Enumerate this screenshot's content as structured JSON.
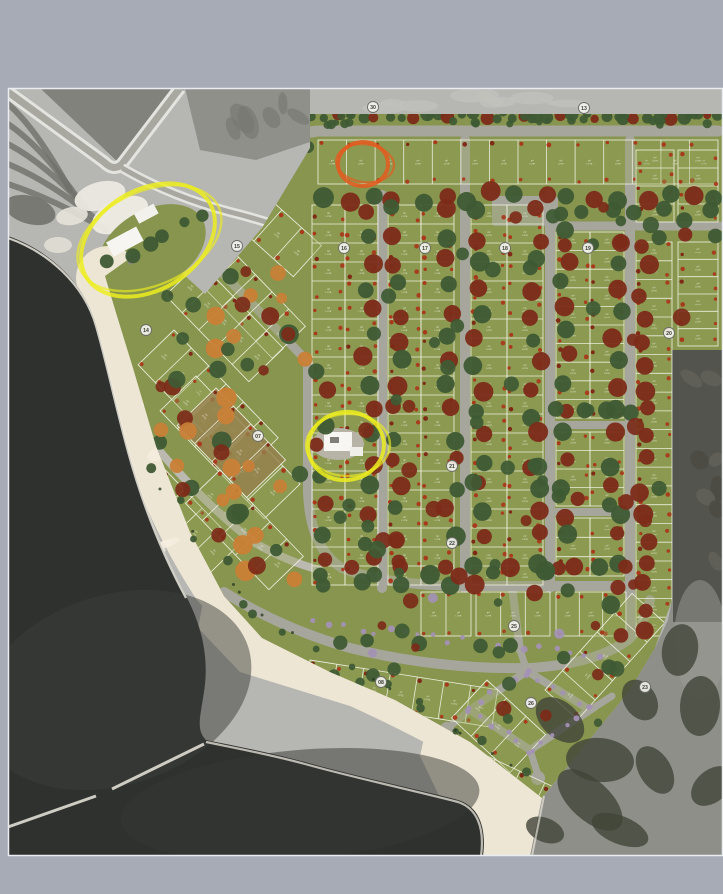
{
  "title": "Aerial master plan rendering of a beachfront lot subdivision with highlighted areas",
  "palette": {
    "bg": "#a6abb5",
    "photoBase": "#b6b6b2",
    "terrainDark": "#7c7c76",
    "terrainMid": "#8a8a84",
    "roadLight": "#e3e3df",
    "roadMid": "#a8a8a1",
    "water": "#2f312e",
    "waterLight": "#3c3e3a",
    "sand": "#eee6d4",
    "foam": "#f8f4e9",
    "green": "#87954e",
    "greenLight": "#95a35a",
    "street": "#a7a69c",
    "streetLight": "#bcbab0",
    "lotLine": "#f0f0e2",
    "tan": "#96804d",
    "treeDark": "#3e5a34",
    "treeRed": "#7c2b19",
    "treeOrange": "#c97f36",
    "treePurple": "#a391b5",
    "lotDot": "#aa3418",
    "grayTerrain": "#8f8f8a",
    "grayDark": "#54544e",
    "grayForest": "#414538",
    "annYellow": "#eced1e",
    "annOrange": "#e45a1f",
    "markerFill": "#f4f4ee",
    "markerStroke": "#6b6b66",
    "markerText": "#3a3a38"
  },
  "lot_label": {
    "area": "m²",
    "type": "LOTE"
  },
  "markers": [
    {
      "label": "30",
      "x": 373,
      "y": 107
    },
    {
      "label": "13",
      "x": 584,
      "y": 108
    },
    {
      "label": "15",
      "x": 237,
      "y": 246
    },
    {
      "label": "16",
      "x": 344,
      "y": 248
    },
    {
      "label": "17",
      "x": 425,
      "y": 248
    },
    {
      "label": "18",
      "x": 505,
      "y": 248
    },
    {
      "label": "19",
      "x": 588,
      "y": 248
    },
    {
      "label": "20",
      "x": 669,
      "y": 333
    },
    {
      "label": "14",
      "x": 146,
      "y": 330
    },
    {
      "label": "07",
      "x": 258,
      "y": 436
    },
    {
      "label": "21",
      "x": 452,
      "y": 466
    },
    {
      "label": "22",
      "x": 452,
      "y": 543
    },
    {
      "label": "25",
      "x": 514,
      "y": 626
    },
    {
      "label": "08",
      "x": 381,
      "y": 682
    },
    {
      "label": "26",
      "x": 531,
      "y": 703
    },
    {
      "label": "23",
      "x": 645,
      "y": 687
    }
  ],
  "annotations": {
    "entrance_area_highlight": {
      "cx": 148,
      "cy": 240,
      "rx": 72,
      "ry": 50,
      "rot": -31,
      "color": "annYellow"
    },
    "highlighted_lot": {
      "cx": 363,
      "cy": 164,
      "rx": 25,
      "ry": 22,
      "rot": 0,
      "color": "annOrange"
    },
    "clubhouse_highlight": {
      "cx": 346,
      "cy": 446,
      "rx": 38,
      "ry": 34,
      "rot": -8,
      "color": "annYellow"
    }
  }
}
